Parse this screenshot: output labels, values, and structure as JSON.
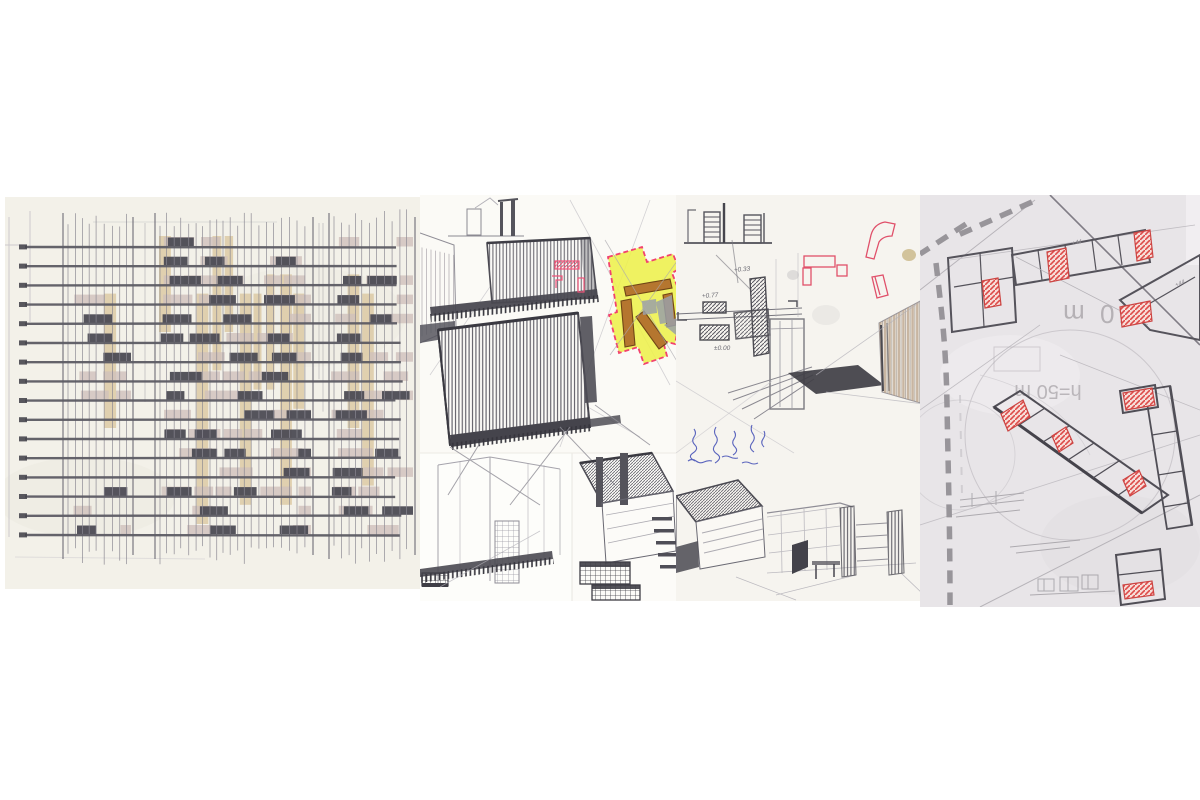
{
  "meta": {
    "description": "Collage strip of four hand-drawn architectural sketch panels",
    "panel_count": 4
  },
  "panels": {
    "facade_study": {
      "name": "facade pattern study",
      "paper_color": "#f3f1e9",
      "rows": 16,
      "palette": {
        "dark": "#4c4b54",
        "tan": "#d8c499",
        "mauve": "#cfc1bb",
        "line": "#5c5b64",
        "guide": "#8b8992",
        "tick": "#47464e"
      }
    },
    "perspective_sketches": {
      "name": "perspective massing sketches with highlighted plan fragment",
      "paper_color": "#fbfaf6",
      "highlight_fill": "#edf04c",
      "highlight_outline": "#f2426e",
      "bar_color": "#b5762f",
      "pink_accent": "#f0557a"
    },
    "plan_and_corridor": {
      "name": "plan fragment, handwritten notes and street perspective",
      "paper_color": "#f6f4ef",
      "red_accent": "#e0506a",
      "ink_color": "#4a55b8",
      "annotations": {
        "upper": "+0.33",
        "left": "+0.77",
        "datum": "±0.00"
      }
    },
    "site_plan": {
      "name": "site plan study on tracing paper",
      "paper_color": "#e8e5e8",
      "red_accent": "#dd4b49",
      "dash_color": "#98959a",
      "mirrored_labels": {
        "radius": "50 m",
        "height": "h=50 m"
      },
      "level_marks": {
        "a": "+44",
        "b": "+44"
      }
    }
  }
}
